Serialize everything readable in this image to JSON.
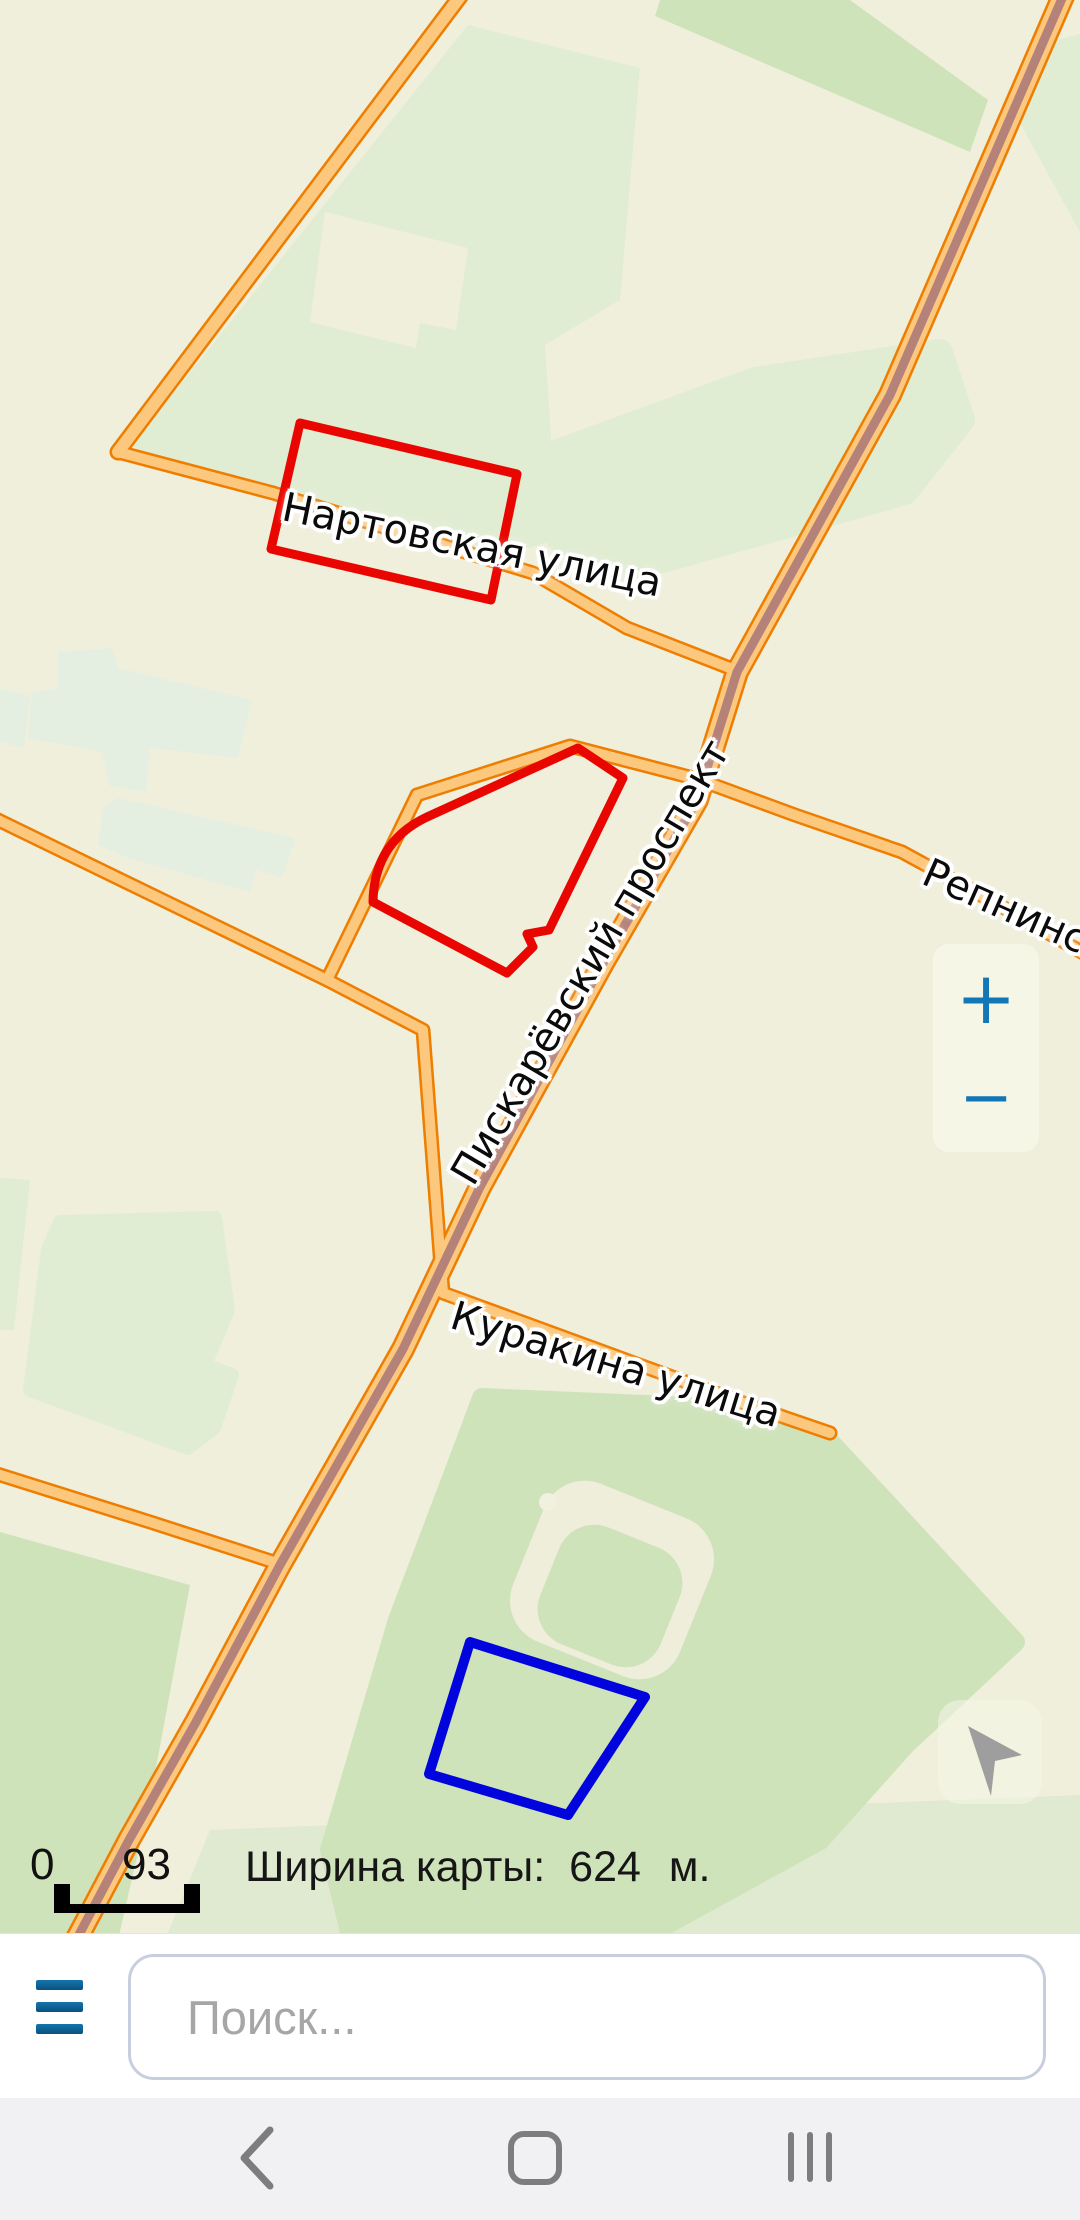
{
  "map": {
    "street_labels": [
      {
        "name": "Нартовская улица"
      },
      {
        "name": "Пискарёвский проспект"
      },
      {
        "name": "Куракина улица"
      },
      {
        "name": "Репнинская"
      }
    ],
    "scale_bar": {
      "start_value": "0",
      "end_value": "93"
    },
    "width_info": {
      "label": "Ширина карты:",
      "value": "624",
      "unit": "м."
    },
    "zoom_controls": {
      "zoom_in_label": "+",
      "zoom_out_label": "−"
    },
    "overlay_shapes": {
      "red_outline_color": "#e90600",
      "blue_outline_color": "#0104dd",
      "red_shape_count": 2,
      "blue_shape_count": 1
    },
    "colors": {
      "background": "#f0efdb",
      "park_green": "#cfe3bb",
      "pale_green": "#e1edd3",
      "road_casing": "#ee7d00",
      "road_fill": "#fcc87e",
      "tram_core": "#b5827a",
      "accent_blue": "#1277b7"
    }
  },
  "search": {
    "placeholder": "Поиск..."
  },
  "navbar": {
    "back_icon": "back-chevron",
    "home_icon": "home-outline-square",
    "recents_icon": "recent-apps-bars"
  }
}
